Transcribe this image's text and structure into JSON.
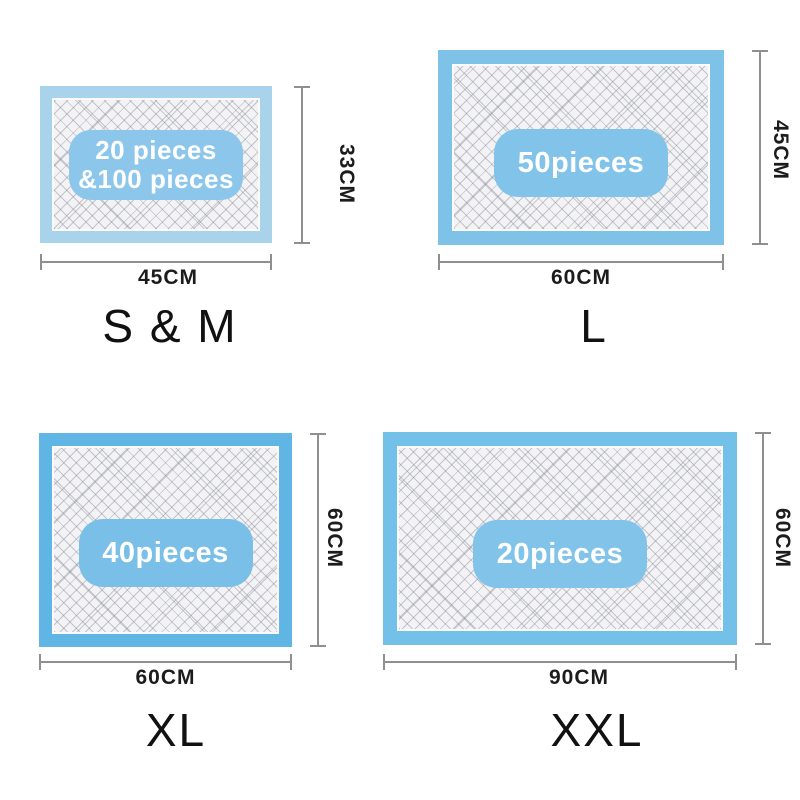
{
  "title": "Pet training pad size chart",
  "background_color": "#ffffff",
  "dimension_line_color": "#8f8f8f",
  "panels": [
    {
      "id": "s-m",
      "size_label": "S & M",
      "badge_lines": [
        "20 pieces",
        "&100 pieces"
      ],
      "width_label": "45CM",
      "height_label": "33CM",
      "border_color": "#a8d3eb",
      "badge_color": "#8cc6ea"
    },
    {
      "id": "l",
      "size_label": "L",
      "badge_lines": [
        "50pieces"
      ],
      "width_label": "60CM",
      "height_label": "45CM",
      "border_color": "#7ec2e8",
      "badge_color": "#82c4e9"
    },
    {
      "id": "xl",
      "size_label": "XL",
      "badge_lines": [
        "40pieces"
      ],
      "width_label": "60CM",
      "height_label": "60CM",
      "border_color": "#5fb6e4",
      "badge_color": "#79bfe8"
    },
    {
      "id": "xxl",
      "size_label": "XXL",
      "badge_lines": [
        "20pieces"
      ],
      "width_label": "90CM",
      "height_label": "60CM",
      "border_color": "#73c0e8",
      "badge_color": "#81c3e9"
    }
  ]
}
